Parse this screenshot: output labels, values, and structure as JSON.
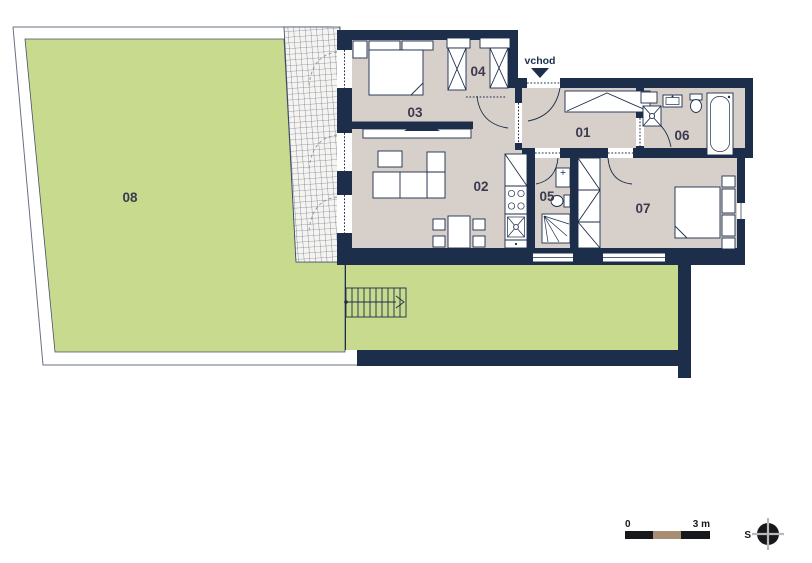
{
  "labels": {
    "room01": "01",
    "room02": "02",
    "room03": "03",
    "room04": "04",
    "room05": "05",
    "room06": "06",
    "room07": "07",
    "room08": "08",
    "entrance": "vchod"
  },
  "scale_bar": {
    "start": "0",
    "end": "3 m"
  },
  "compass": {
    "direction": "S"
  },
  "colors": {
    "wall": "#1c2e4a",
    "floor": "#d7cfc9",
    "grass": "#c8da8d",
    "tile": "#f6f4f0",
    "tile_line": "#3a4a66",
    "label": "#3c3a4e",
    "tan": "#a78e72",
    "line": "#6a7080",
    "scale_dark": "#17181c"
  }
}
